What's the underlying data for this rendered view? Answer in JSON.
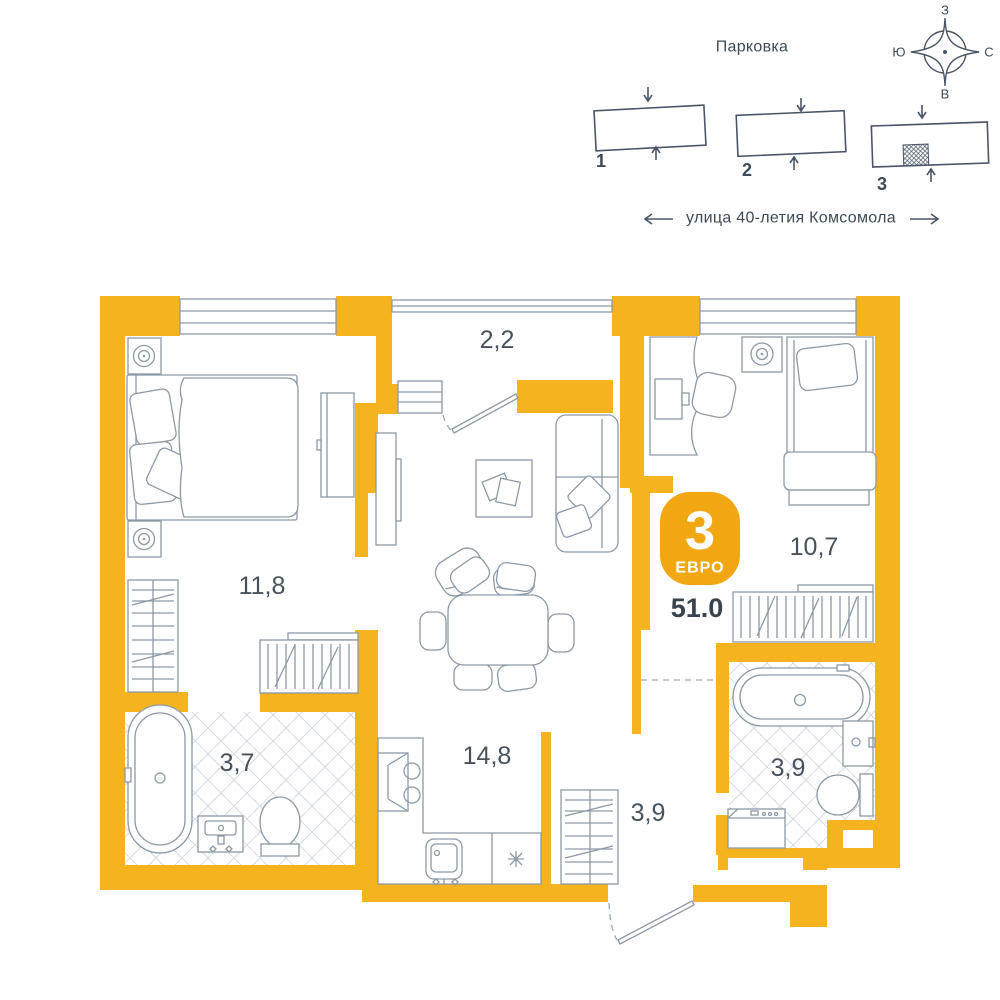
{
  "colors": {
    "wall": "#F5B41E",
    "badge": "#F0A712",
    "ink": "#3D4A57",
    "line": "#8C99A6",
    "area": "#47525E"
  },
  "site": {
    "parking_label": "Парковка",
    "street_label": "улица 40-летия Комсомола",
    "compass": {
      "west": "З",
      "north": "С",
      "east": "В",
      "south": "Ю"
    },
    "buildings": [
      {
        "label": "1"
      },
      {
        "label": "2"
      },
      {
        "label": "3",
        "marked": true
      }
    ]
  },
  "plan": {
    "rooms": {
      "bedroom1": "11,8",
      "balcony": "2,2",
      "bedroom2": "10,7",
      "living": "14,8",
      "bath1": "3,7",
      "hall": "3,9",
      "bath2": "3,9"
    },
    "badge": {
      "count": "3",
      "type": "ЕВРО",
      "total_area": "51.0"
    }
  }
}
